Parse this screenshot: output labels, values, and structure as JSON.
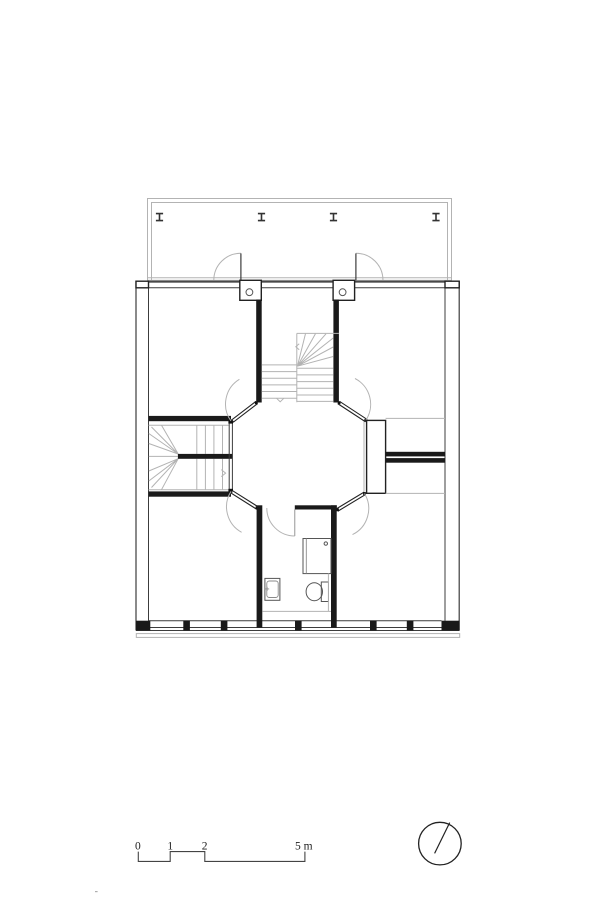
{
  "drawing": {
    "kind": "architectural-floor-plan-upper-storey",
    "background": "#ffffff",
    "colors": {
      "wall_fill": "#1a1a1a",
      "wall_line": "#3c3c3c",
      "light_line": "#b3b3b3",
      "fixture_line": "#555555",
      "text": "#222222"
    },
    "elements": [
      {
        "name": "balcony-loggia",
        "markers": "steel-column-i-beam",
        "marker_count": 4
      },
      {
        "name": "top-left-room"
      },
      {
        "name": "top-right-room"
      },
      {
        "name": "central-stair",
        "style": "straight-flights-with-winders"
      },
      {
        "name": "left-winder-stair",
        "style": "switchback-with-handrail-bar"
      },
      {
        "name": "octagonal-hall",
        "corner_doors": 4
      },
      {
        "name": "right-closet-niches",
        "count": 2
      },
      {
        "name": "bathroom",
        "fixtures": [
          "shower",
          "washbasin",
          "toilet"
        ]
      },
      {
        "name": "bottom-left-room"
      },
      {
        "name": "bottom-right-room"
      },
      {
        "name": "window-band-bottom",
        "mullion_count": 5
      }
    ]
  },
  "scale_bar": {
    "unit": "m",
    "ticks": [
      {
        "label": "0",
        "x": 138.3
      },
      {
        "label": "1",
        "x": 170.2
      },
      {
        "label": "2",
        "x": 204.8
      },
      {
        "label": "5 m",
        "x": 304.9
      }
    ]
  },
  "north_indicator": {
    "icon": "north-circle-icon",
    "needle_direction": "north-east"
  }
}
